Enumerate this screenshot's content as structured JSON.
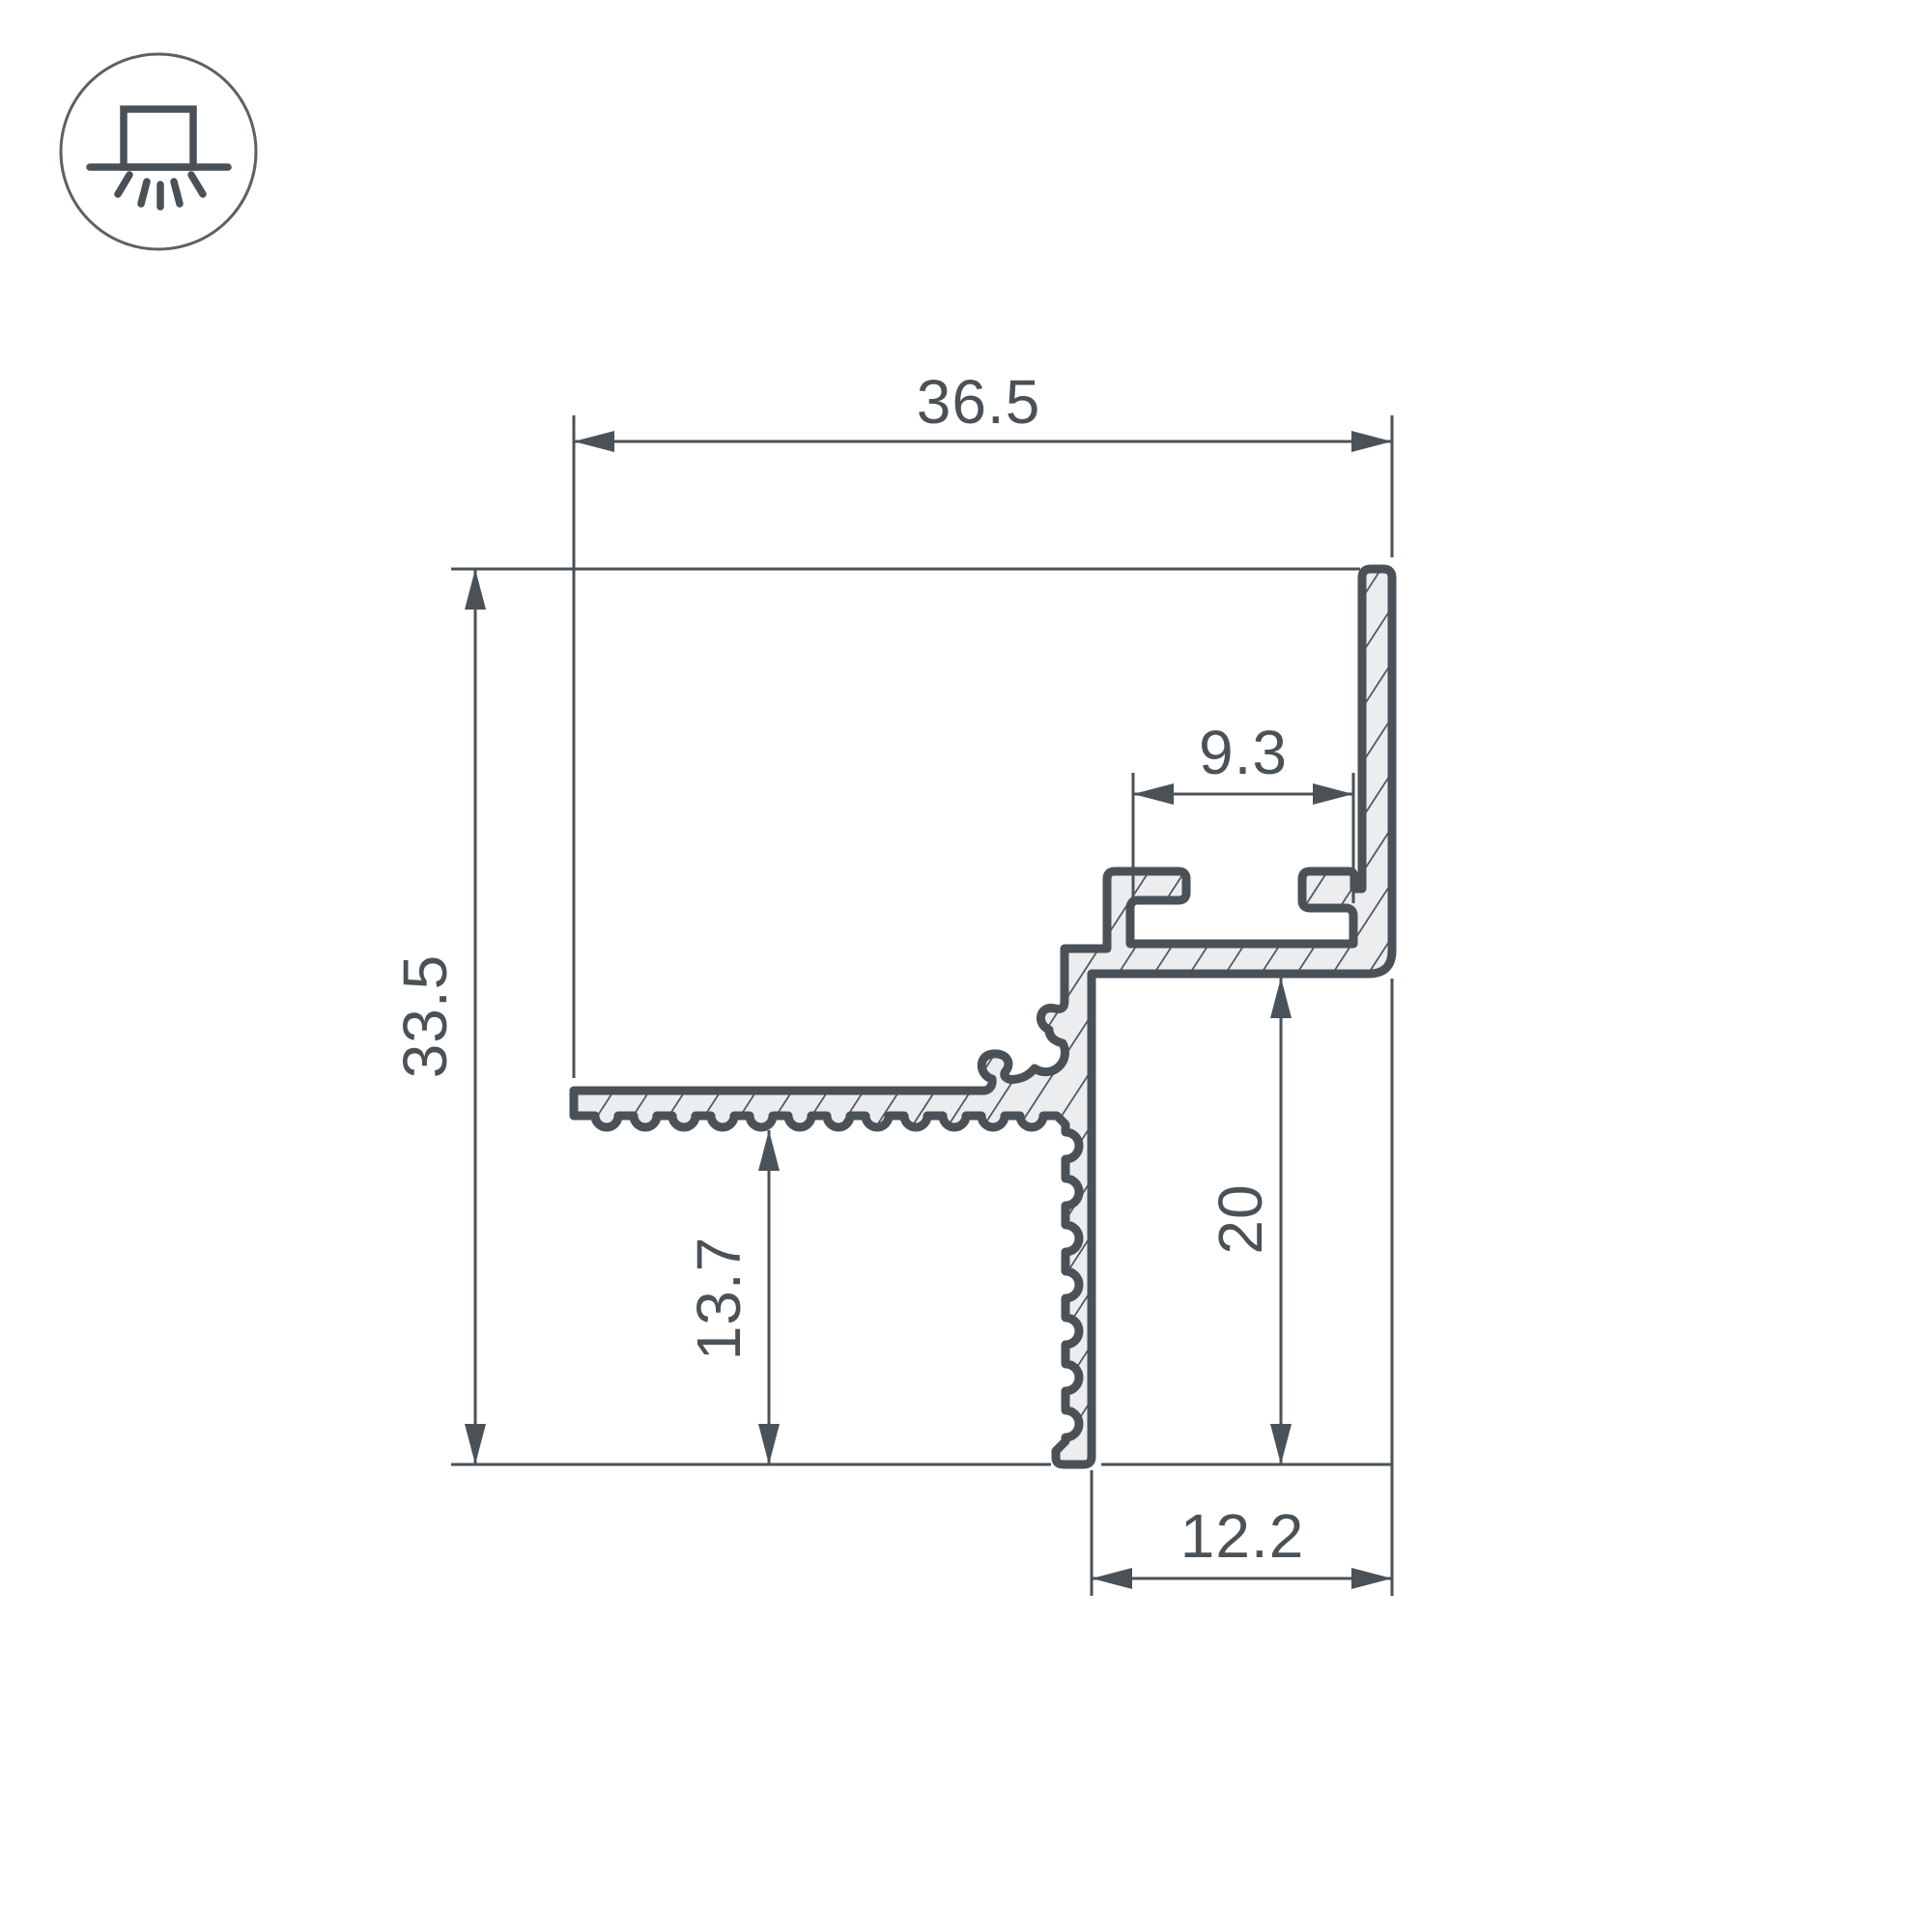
{
  "page": {
    "background": "#ffffff",
    "kind": "technical-drawing-profile-cross-section"
  },
  "colors": {
    "line": "#4a5258",
    "hatch_fill": "#ecedee",
    "icon_circle_stroke": "#5b6167"
  },
  "icon": {
    "name": "surface-mounted-luminaire-icon"
  },
  "drawing": {
    "units": "mm",
    "dims": {
      "overall_width": "36.5",
      "overall_height": "33.5",
      "slot_width": "9.3",
      "flange_height": "13.7",
      "recess_height": "20",
      "bottom_width": "12.2"
    }
  }
}
